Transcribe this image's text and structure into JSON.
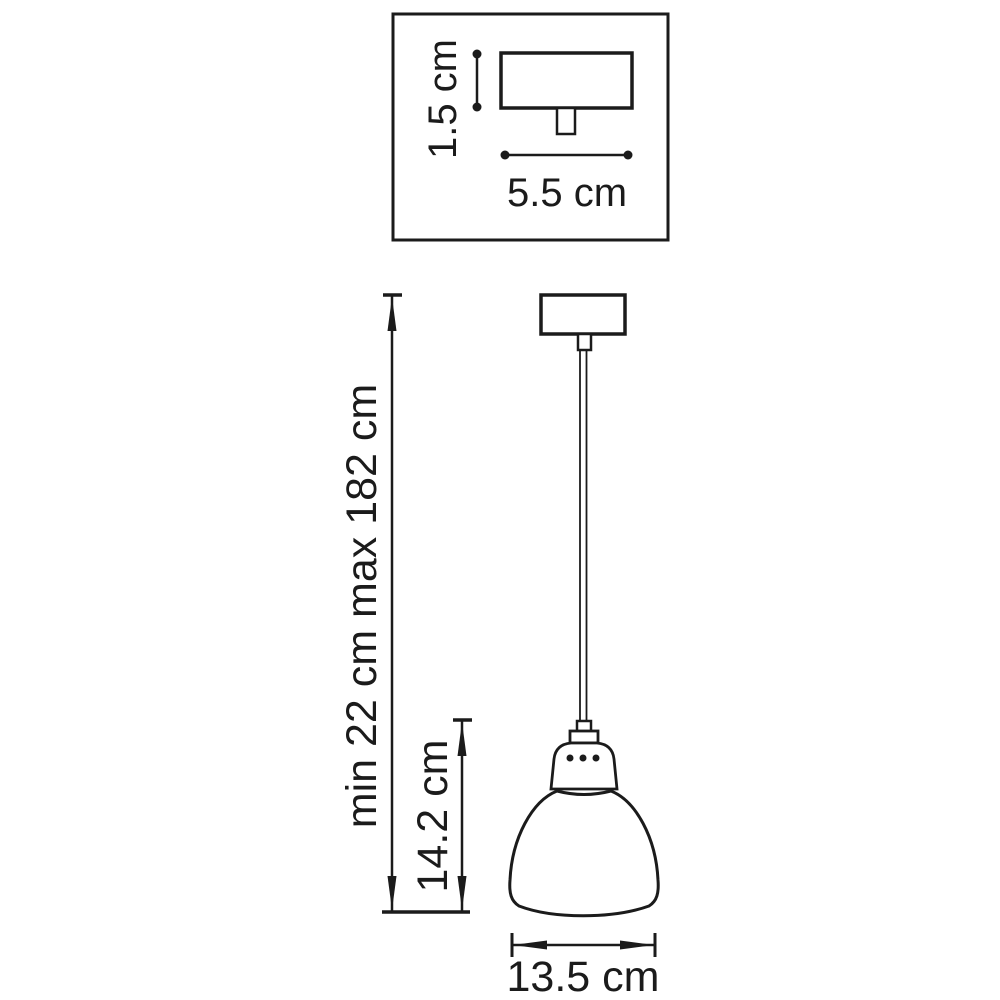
{
  "colors": {
    "line": "#1b1b1b",
    "background": "#ffffff"
  },
  "detail_inset": {
    "canopy_height_label": "1.5 cm",
    "canopy_width_label": "5.5 cm"
  },
  "dimensions": {
    "suspension_height_label": "min 22 cm max 182 cm",
    "shade_height_label": "14.2 cm",
    "shade_diameter_label": "13.5 cm"
  }
}
